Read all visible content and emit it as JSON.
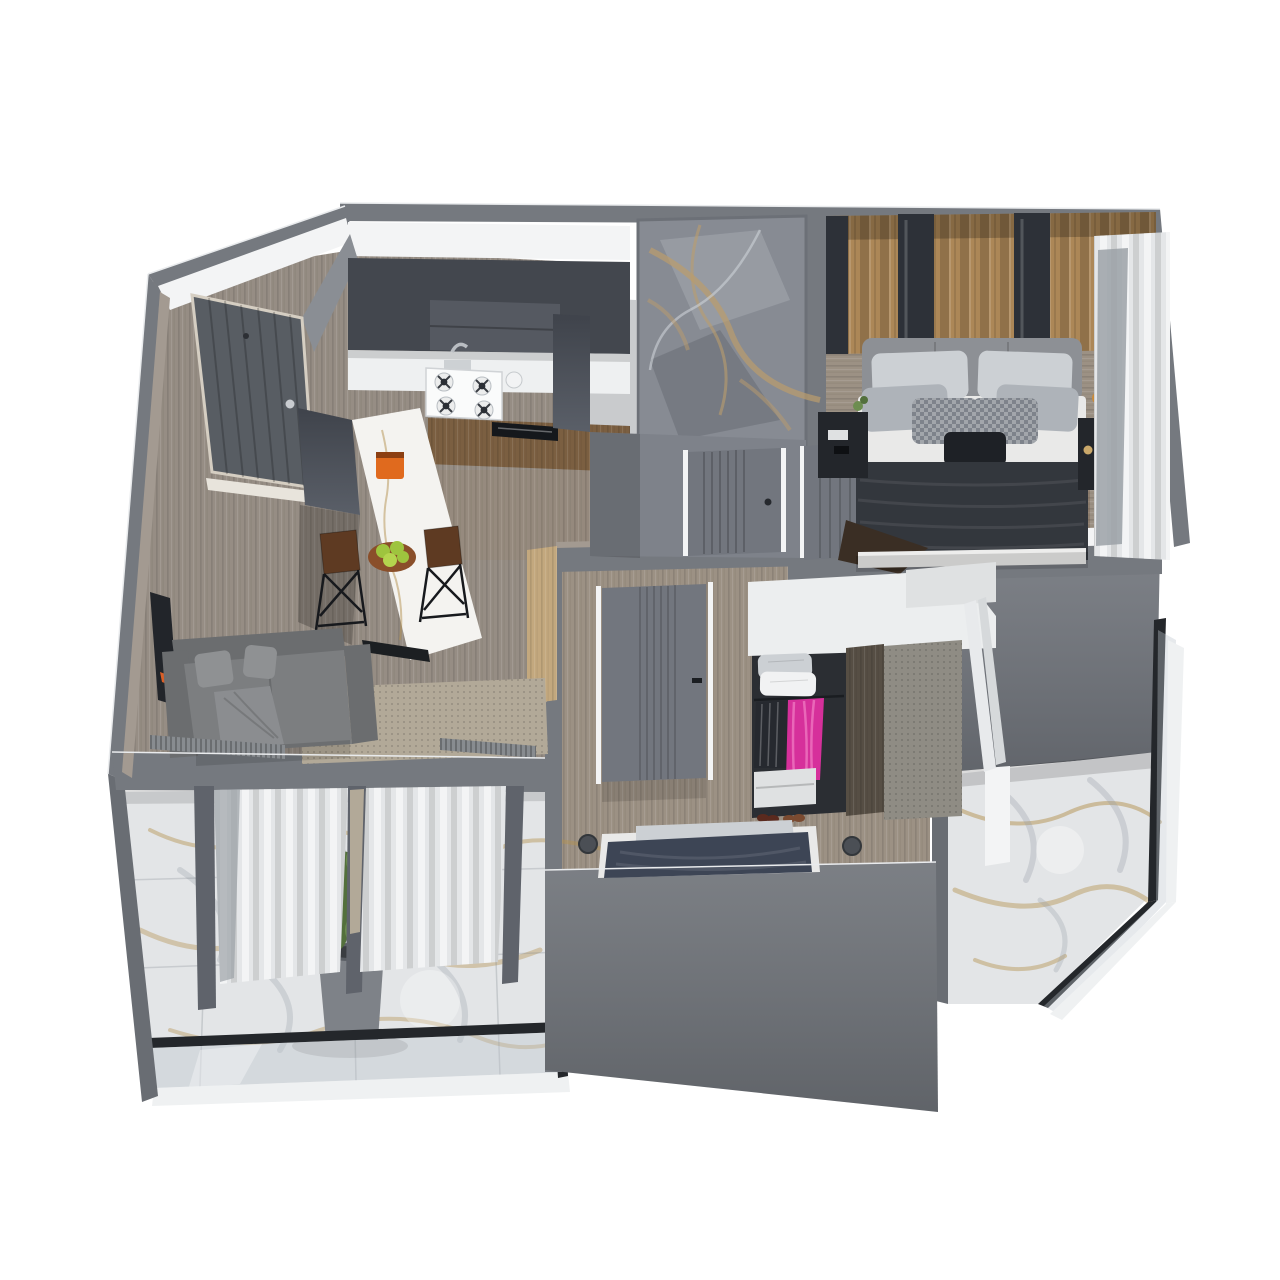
{
  "scene": {
    "type": "3d-floor-plan-render",
    "view": "axonometric-cutaway-top-down",
    "background": "#ffffff"
  },
  "colors": {
    "bg": "#ffffff",
    "wallOuter": "#75797f",
    "wallOuterDark": "#696d73",
    "wallLight": "#83878e",
    "wallFace": "#6d7177",
    "wallBeige": "#a39a91",
    "ceiling": "#f3f4f5",
    "floorWood": "#968d84",
    "floorHall": "#95897d",
    "floorBed": "#9c9184",
    "thresholdWood": "#c3a87e",
    "cabinetDark": "#43474e",
    "cabinetHood": "#555961",
    "counter": "#eef0f1",
    "hobWhite": "#fafbfb",
    "cabinetWood": "#7b5f41",
    "appliance": "#15181c",
    "islandWhite": "#f4f3f0",
    "machineOrange": "#e06a1e",
    "bowlBrown": "#8a4f2a",
    "appleGreen": "#9ec43e",
    "stoolSeat": "#5e3a22",
    "wire": "#17191d",
    "matBlack": "#1c1f22",
    "sofa": "#7c7e80",
    "sofaDark": "#6b6d6f",
    "pillowSofa": "#8f9193",
    "blanketSofa": "#8b8d90",
    "tv": "#22252a",
    "tvOrange": "#d95f28",
    "rug": "#b2a998",
    "radiator": "#888c90",
    "post": "#5f636b",
    "curtain": "#e4e6e8",
    "curtainGray": "#9ba1a7",
    "doorEntry": "#585d63",
    "door": "#72767e",
    "frame": "#d5cec2",
    "marbleBase": "#878b93",
    "marbleVein": "#bb9c6c",
    "marbleLight": "#aab0b6",
    "marbleDark": "#5d616a",
    "slat": "#ac8757",
    "mirror": "#2d3138",
    "headboard": "#8d9095",
    "mattress": "#e9e9e8",
    "pillowL": "#ccd0d4",
    "pillowM": "#aeb3b9",
    "pillowP": "#7e838b",
    "pillowDark": "#1e2126",
    "blanketBed": "#33373d",
    "throwBrown": "#3a2e24",
    "nightstand": "#23262b",
    "flowerAmber": "#c98a3a",
    "tile": "#e3e5e7",
    "veinGold": "#b3924f",
    "veinGray": "#98a0a8",
    "rail": "#24272b",
    "glass": "rgba(190,198,205,0.38)",
    "plant": "#53703c",
    "plantLight": "#6d8d50",
    "pot": "#7e8288",
    "wardrobeWhite": "#eceeef",
    "wardrobeShade": "#dfe1e2",
    "closetDark": "#2b2e33",
    "clothesDark": "#26292f",
    "pink": "#d6309b",
    "pinkLight": "#e967b8",
    "shoeDark": "#5a2a1e",
    "shoeBrown": "#7a4a30",
    "panelWood": "#564e44",
    "panelFabric": "#8f8c84",
    "boardWhite": "#e8eaec",
    "navy": "#3d4555",
    "knob": "#4b4f55"
  },
  "rooms": [
    {
      "id": "entry-hall",
      "objects": [
        "entry-door",
        "entry-cabinet-panel",
        "wood-floor"
      ]
    },
    {
      "id": "kitchen",
      "objects": [
        "upper-cabinets",
        "range-hood",
        "countertop",
        "gas-hob",
        "sink-faucet",
        "base-cabinets-wood",
        "dishwasher",
        "tall-column",
        "kitchen-island",
        "espresso-machine",
        "fruit-bowl",
        "bar-stools",
        "floor-mat"
      ]
    },
    {
      "id": "living-room",
      "objects": [
        "corner-sofa",
        "throw-pillows",
        "throw-blanket",
        "tv-panel",
        "area-rug",
        "radiators",
        "window-frames",
        "sheer-curtains"
      ]
    },
    {
      "id": "bathroom",
      "objects": [
        "marble-feature-wall",
        "bathroom-door"
      ]
    },
    {
      "id": "hallway",
      "objects": [
        "hall-floor",
        "threshold-strip",
        "bedroom-door"
      ]
    },
    {
      "id": "bedroom-primary",
      "objects": [
        "wood-slat-wall",
        "mirror-strips",
        "upholstered-headboard",
        "double-bed",
        "pillows",
        "dark-blanket",
        "brown-throw",
        "nightstand-left",
        "nightstand-right",
        "vase-flowers",
        "window-curtains"
      ]
    },
    {
      "id": "bedroom-second",
      "objects": [
        "interior-door",
        "open-wardrobe",
        "pillow-stack",
        "hanging-clothes-dark",
        "hanging-clothes-pink",
        "drawer-unit",
        "shoes",
        "wood-panel",
        "fabric-panel",
        "leaning-boards",
        "bed-navy-blanket",
        "floor-spots"
      ]
    },
    {
      "id": "balcony-left",
      "objects": [
        "marble-tile-floor",
        "potted-plant",
        "glass-railing",
        "white-edge"
      ]
    },
    {
      "id": "balcony-right",
      "objects": [
        "marble-tile-floor",
        "glass-railing",
        "chamfered-corner",
        "white-edge"
      ]
    }
  ]
}
